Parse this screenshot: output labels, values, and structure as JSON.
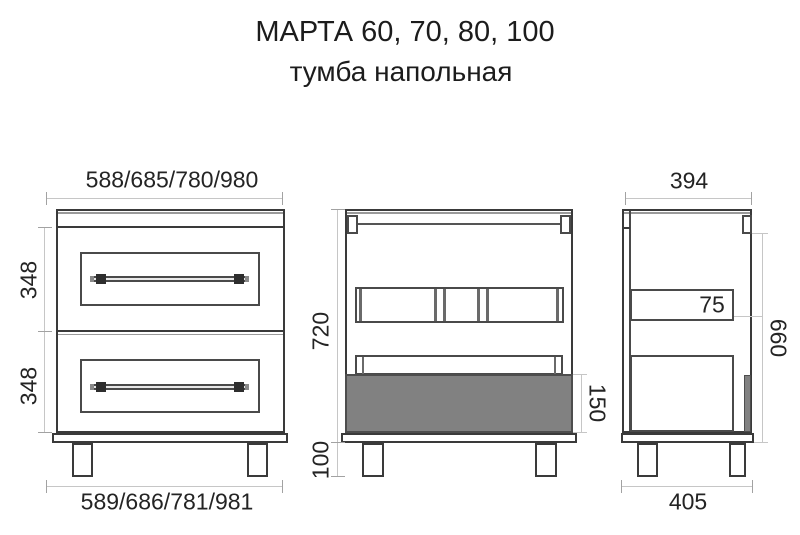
{
  "title": "МАРТА 60, 70, 80, 100",
  "subtitle": "тумба напольная",
  "front_view": {
    "width_top": "588/685/780/980",
    "width_bottom": "589/686/781/981",
    "drawer1_height": "348",
    "drawer2_height": "348"
  },
  "section_view": {
    "body_height": "720",
    "leg_height": "100",
    "drawer_box_height": "150"
  },
  "side_view": {
    "depth_top": "394",
    "depth_bottom": "405",
    "rail_height": "75",
    "side_height": "660"
  },
  "colors": {
    "line_main": "#3a3a3a",
    "line_dimension": "#c6c6c6",
    "drawer_box_fill": "#818181",
    "background": "#ffffff",
    "text": "#242424"
  }
}
